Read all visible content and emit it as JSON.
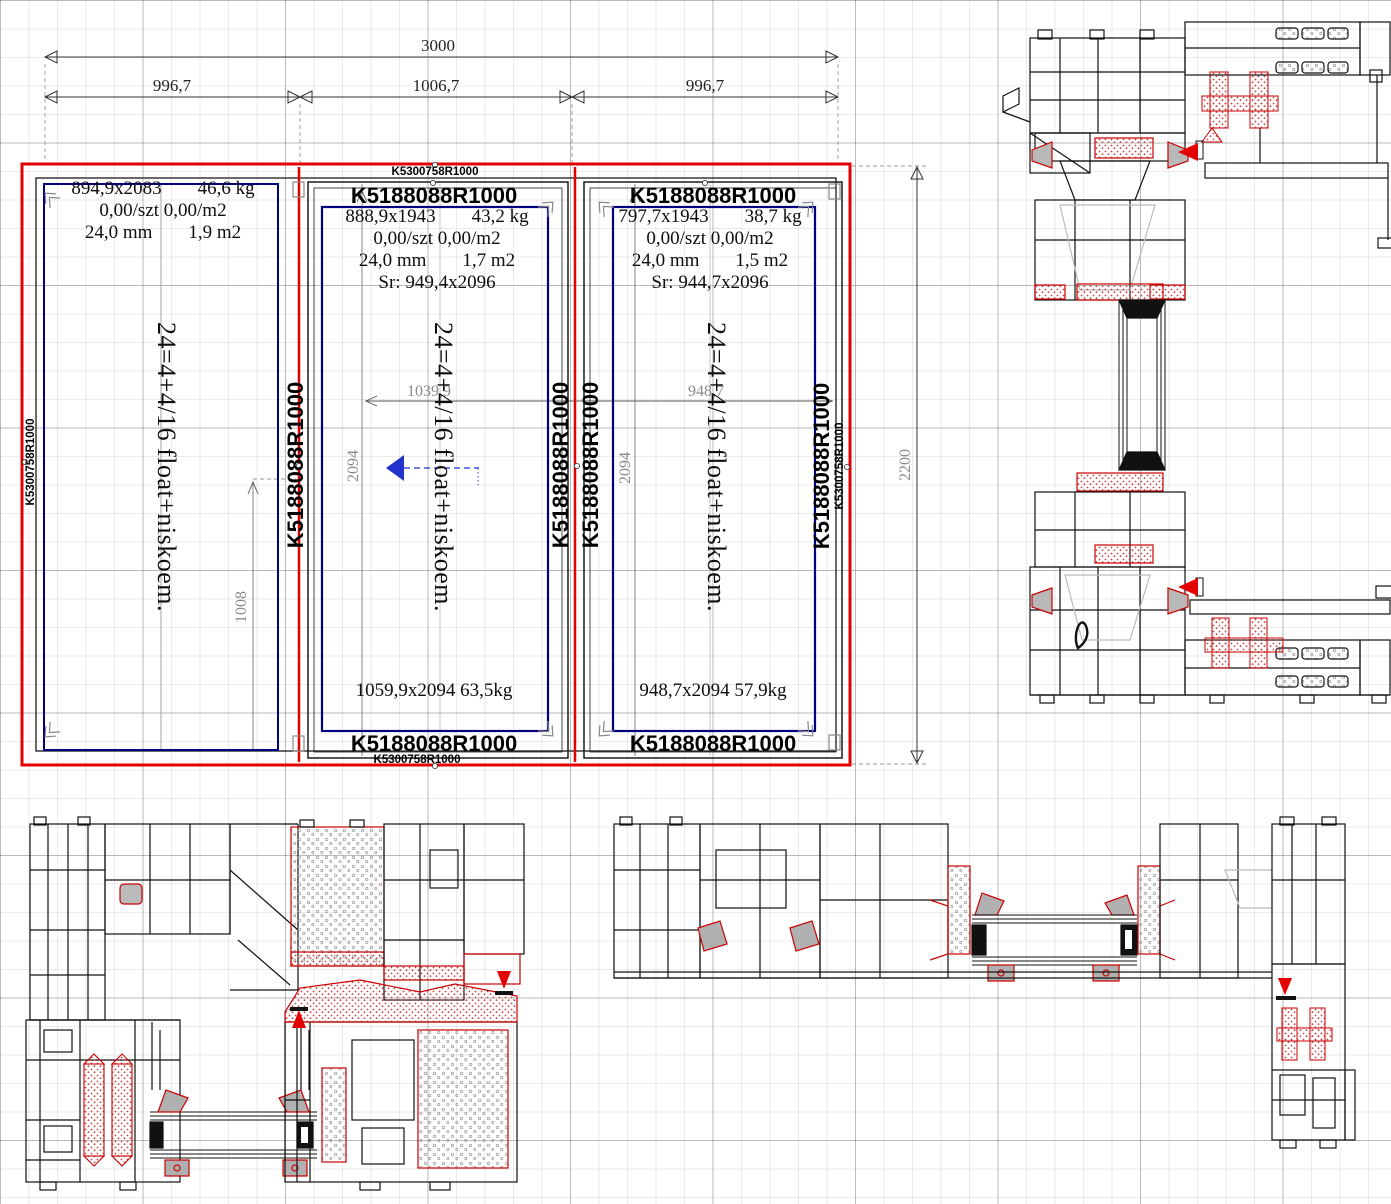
{
  "window_drawing": {
    "labels": {
      "frame_top": "K5300758R1000",
      "frame_bottom": "K5300758R1000",
      "frame_left": "K5300758R1000",
      "frame_right_outer": "K5300758R1000",
      "frame_right_inner": "K5188088R1000",
      "mullion_left": "K5188088R1000",
      "sash_mid_right": "K5188088R1000",
      "sash_right_left": "K5188088R1000",
      "sash_mid_top": "K5188088R1000",
      "sash_right_top": "K5188088R1000",
      "sash_mid_bottom": "K5188088R1000",
      "sash_right_bottom": "K5188088R1000"
    },
    "panes": [
      {
        "name": "fixed-left",
        "size": "894,9x2083",
        "weight": "46,6 kg",
        "price": "0,00/szt 0,00/m2",
        "thickness": "24,0 mm",
        "area": "1,9 m2",
        "glazing": "24=4+4/16 float+niskoem."
      },
      {
        "name": "sash-middle",
        "size": "888,9x1943",
        "weight": "43,2 kg",
        "price": "0,00/szt 0,00/m2",
        "thickness": "24,0 mm",
        "area": "1,7 m2",
        "sr": "Sr: 949,4x2096",
        "glazing": "24=4+4/16 float+niskoem.",
        "sash_size": "1059,9x2094 63,5kg"
      },
      {
        "name": "sash-right",
        "size": "797,7x1943",
        "weight": "38,7 kg",
        "price": "0,00/szt 0,00/m2",
        "thickness": "24,0 mm",
        "area": "1,5 m2",
        "sr": "Sr: 944,7x2096",
        "glazing": "24=4+4/16 float+niskoem.",
        "sash_size": "948,7x2094 57,9kg"
      }
    ],
    "dimensions": {
      "total_width": "3000",
      "left_width": "996,7",
      "mid_width": "1006,7",
      "right_width": "996,7",
      "total_height": "2200",
      "fixed_partial_height": "1008",
      "mid_glass_width": "1039,9",
      "mid_glass_height": "2094",
      "right_glass_width": "948,7",
      "right_glass_height": "2094"
    },
    "colors": {
      "frame_red": "#e30000",
      "glass_edge_navy": "#000080",
      "opening_arrow_blue": "#2233cc",
      "gasket_red": "#cc0000"
    }
  }
}
